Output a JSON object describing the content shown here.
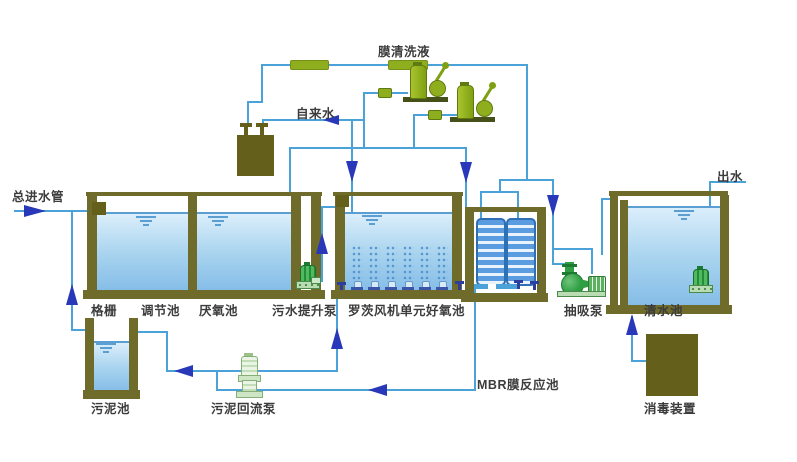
{
  "labels": {
    "inlet": "总进水管",
    "membrane_cleaning": "膜清洗液",
    "tap_water": "自来水",
    "outlet": "出水",
    "grid": "格栅",
    "regulating_tank": "调节池",
    "anaerobic_tank": "厌氧池",
    "lift_pump": "污水提升泵",
    "roots_aerobic_tank": "罗茨风机单元好氧池",
    "suction_pump": "抽吸泵",
    "clear_water_tank": "清水池",
    "mbr_tank": "MBR膜反应池",
    "sludge_tank": "污泥池",
    "sludge_return_pump": "污泥回流泵",
    "disinfection_unit": "消毒装置"
  },
  "colors": {
    "pipe": "#4ba2d8",
    "arrow": "#2838b8",
    "wall": "#6f6b2b",
    "box": "#655f1c",
    "water_top": "#dbeefb",
    "water_mid": "#a9d4ef",
    "water_deep": "#84bce7",
    "surface": "#5a9ed2",
    "equip_green": "#8fae1e",
    "equip_base": "#46511a",
    "pump_green": "#3aa345",
    "pump_pale": "#b9dcb2",
    "module_blue": "#5b9ce0",
    "module_border": "#2f6fb4",
    "label_text": "#3c3c3c"
  }
}
